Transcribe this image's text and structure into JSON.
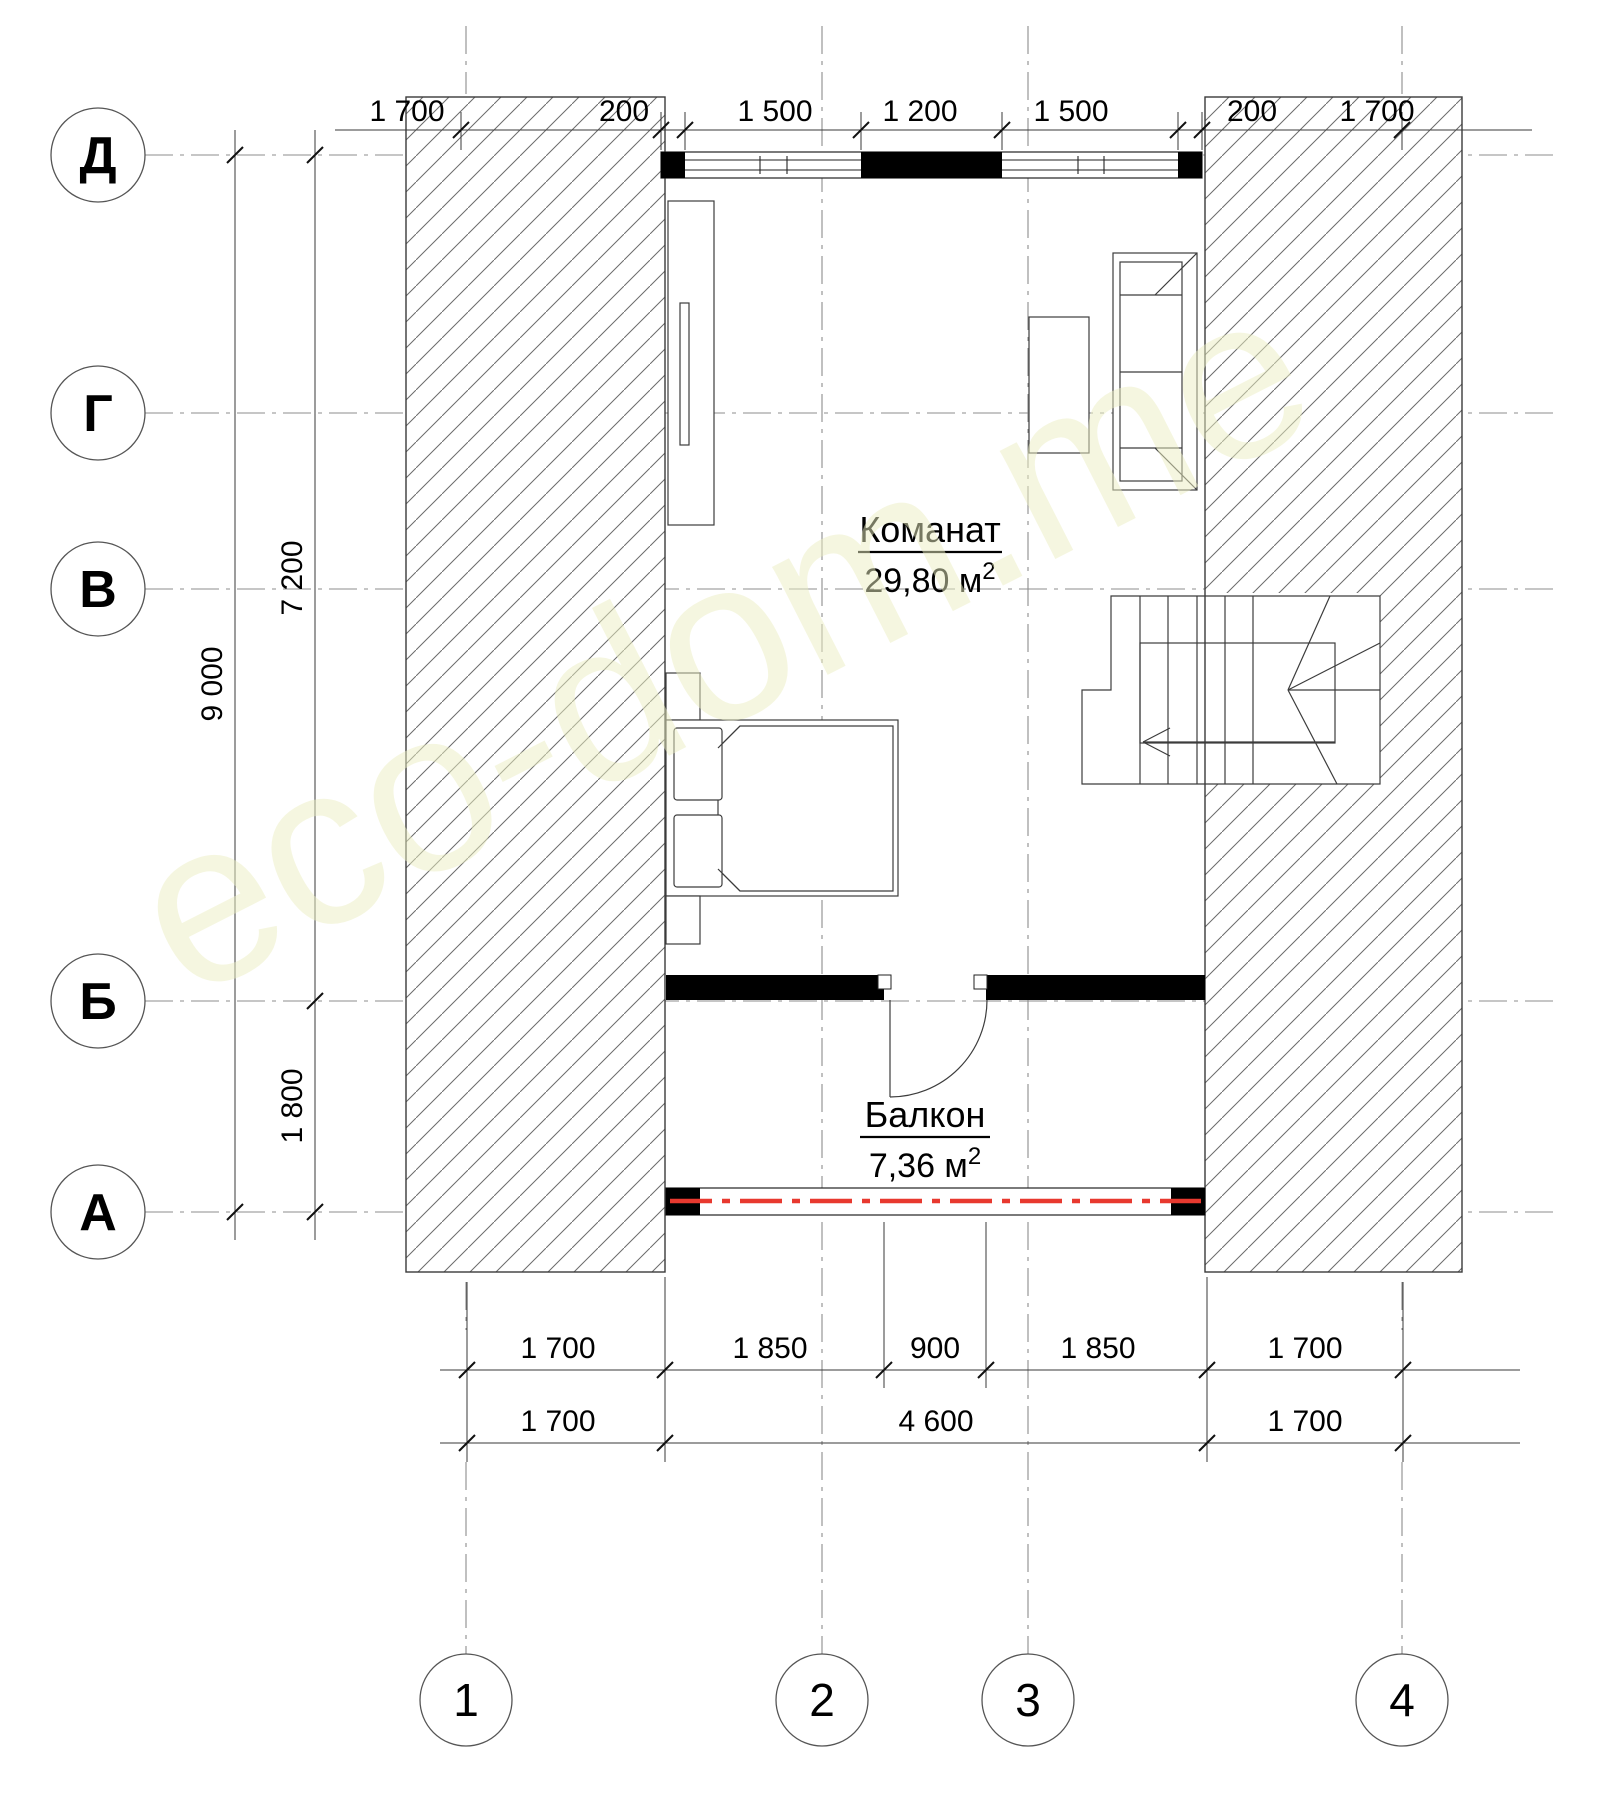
{
  "axes": {
    "rows": [
      "Д",
      "Г",
      "В",
      "Б",
      "А"
    ],
    "cols": [
      "1",
      "2",
      "3",
      "4"
    ]
  },
  "dims": {
    "top": [
      "1 700",
      "200",
      "1 500",
      "1 200",
      "1 500",
      "200",
      "1 700"
    ],
    "left": [
      "9 000",
      "7 200",
      "1 800"
    ],
    "bottom1": [
      "1 700",
      "1 850",
      "900",
      "1 850",
      "1 700"
    ],
    "bottom2": [
      "1 700",
      "4 600",
      "1 700"
    ]
  },
  "rooms": {
    "room": {
      "name": "Команат",
      "area": "29,80 м",
      "sup": "2"
    },
    "balcony": {
      "name": "Балкон",
      "area": "7,36 м",
      "sup": "2"
    }
  },
  "watermark": "eco-dom.me",
  "colors": {
    "red_line": "#e8392f",
    "hatch_line": "#6b6b6b",
    "axis_line": "#8c8c8c",
    "wall": "#000000",
    "watermark": "#ecefc2"
  }
}
